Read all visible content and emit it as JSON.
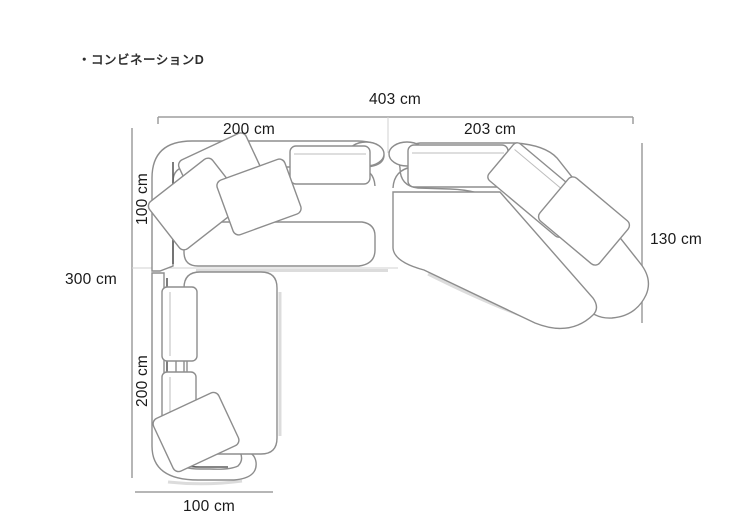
{
  "title": "・コンビネーションD",
  "diagram": {
    "name": "sofa-combination-floorplan",
    "dimensions": {
      "total_width": "403 cm",
      "left_section_width": "200 cm",
      "right_section_width": "203 cm",
      "upper_left_depth": "100 cm",
      "total_height": "300 cm",
      "lower_left_height": "200 cm",
      "right_depth": "130 cm",
      "bottom_width": "100 cm"
    },
    "colors": {
      "background": "#ffffff",
      "sofa_outline": "#8d8d8d",
      "sofa_outline_dark": "#5d5d5d",
      "dimension_line": "#9e9e9e",
      "label_text": "#1a1a1a",
      "title_text": "#2e2e2e"
    }
  }
}
